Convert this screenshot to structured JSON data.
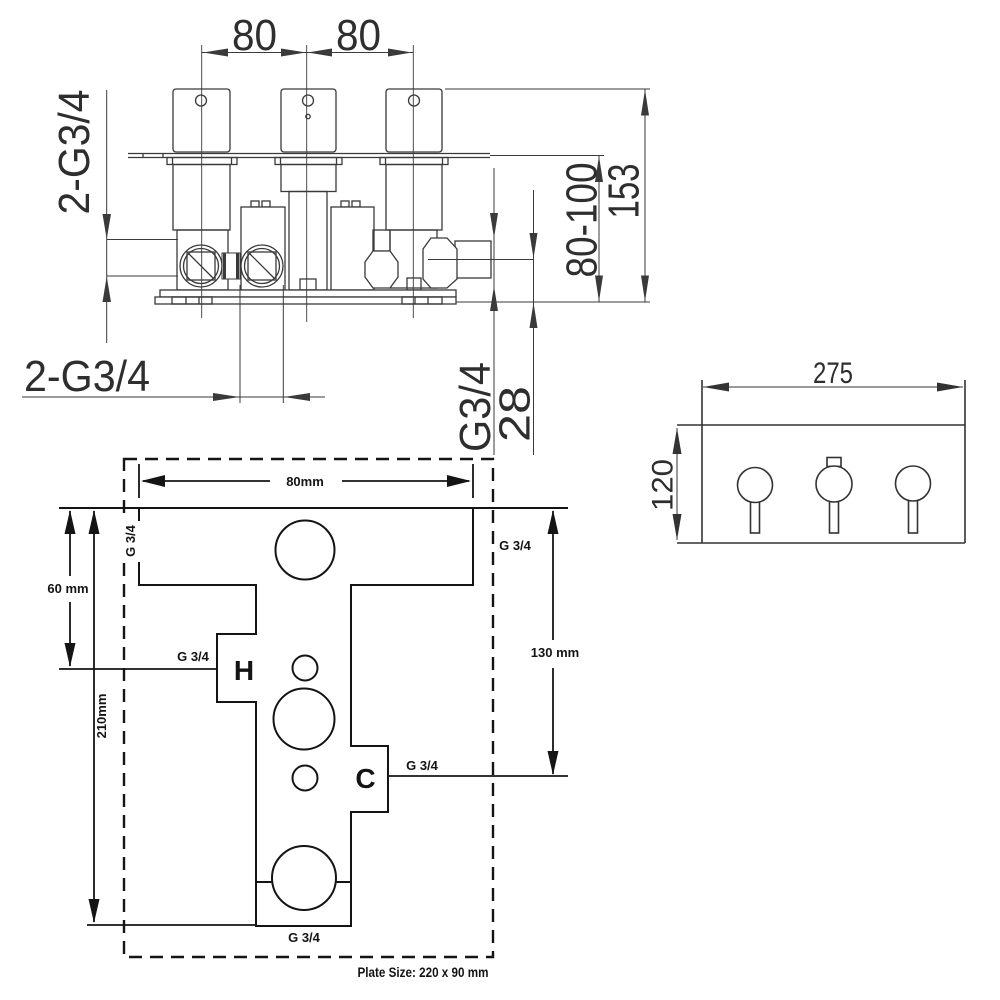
{
  "top_view": {
    "dim_handle_spacing_left": "80",
    "dim_handle_spacing_right": "80",
    "label_inlet_ports_side": "2-G3/4",
    "label_inlet_ports_bottom": "2-G3/4",
    "dim_total_height": "153",
    "dim_fitting_depth": "80-100",
    "label_outlet_port": "G3/4",
    "dim_outlet_offset": "28"
  },
  "plate_view": {
    "dim_width": "275",
    "dim_height": "120"
  },
  "template_view": {
    "dim_plate_width": "80mm",
    "dim_top_port_offset": "60 mm",
    "dim_total_height": "210mm",
    "dim_cold_port_offset": "130 mm",
    "label_port_top_left": "G 3/4",
    "label_port_top_right": "G 3/4",
    "label_hot_port": "G 3/4",
    "label_cold_port": "G 3/4",
    "label_bottom_port": "G 3/4",
    "marker_hot": "H",
    "marker_cold": "C",
    "note_plate_size": "Plate Size: 220 x 90 mm"
  },
  "colors": {
    "line": "#3a3a3a",
    "line_bold": "#141414",
    "text": "#2e2e2e",
    "background": "#ffffff"
  }
}
